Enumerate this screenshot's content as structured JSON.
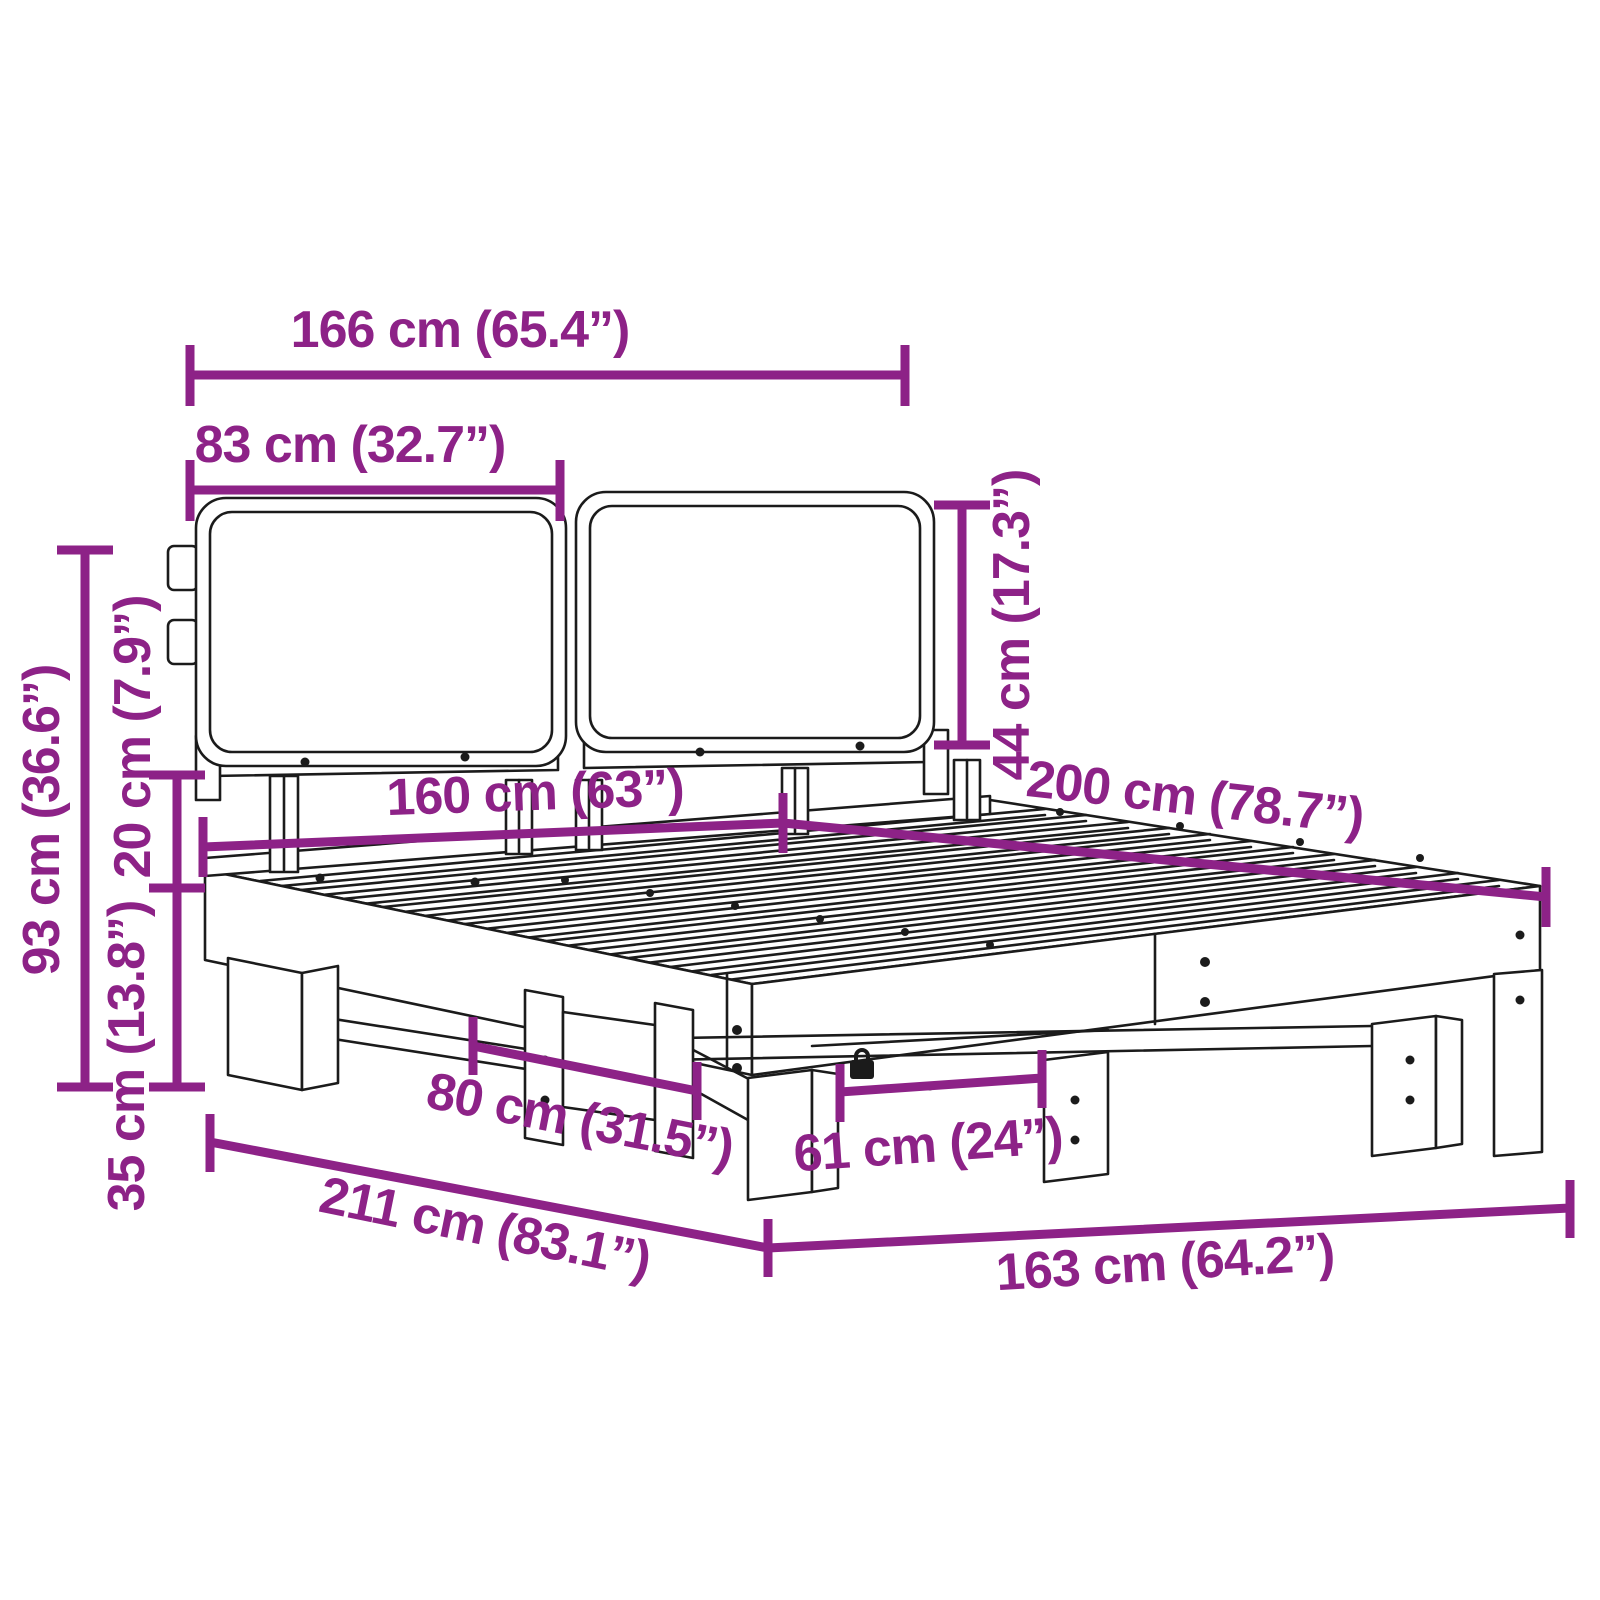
{
  "diagram": {
    "title_hint": "bed frame dimension diagram",
    "accent_color": "#8D2287",
    "line_color": "#1b1b1b",
    "dimensions": {
      "headboard_width": "166 cm (65.4”)",
      "cushion_width": "83 cm (32.7”)",
      "cushion_height": "44 cm (17.3”)",
      "headboard_height": "93 cm (36.6”)",
      "clearance_height": "20 cm (7.9”)",
      "frame_height": "35 cm (13.8”)",
      "bed_width": "160 cm (63”)",
      "bed_length": "200 cm (78.7”)",
      "leg_spacing_width": "80 cm (31.5”)",
      "diagonal_length": "211 cm (83.1”)",
      "leg_spacing_length": "61 cm (24”)",
      "base_length": "163 cm (64.2”)"
    }
  }
}
